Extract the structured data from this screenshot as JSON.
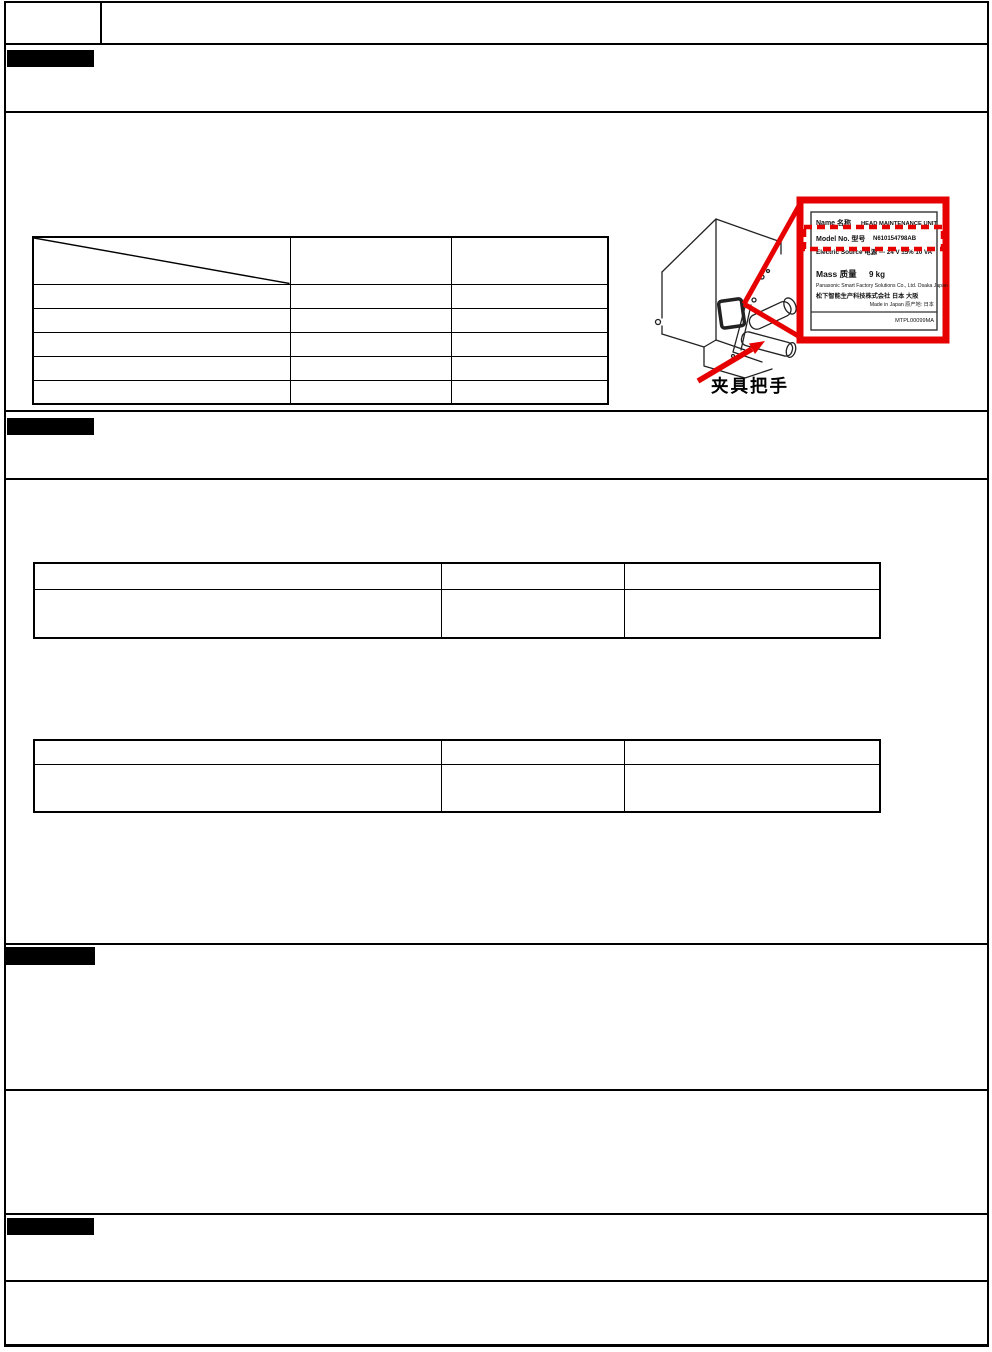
{
  "page": {
    "accent_color": "#e60000",
    "line_color": "#000000",
    "background": "#ffffff"
  },
  "header": {
    "left_cell": "",
    "title_cell": ""
  },
  "section_bars": {
    "bar1": "",
    "bar2": "",
    "bar3": "",
    "bar4": ""
  },
  "tables": {
    "overview": {
      "columns": [
        "",
        "",
        ""
      ],
      "rows": [
        [
          "",
          "",
          ""
        ],
        [
          "",
          "",
          ""
        ],
        [
          "",
          "",
          ""
        ],
        [
          "",
          "",
          ""
        ],
        [
          "",
          "",
          ""
        ]
      ]
    },
    "spec_a": {
      "columns": [
        "",
        "",
        ""
      ],
      "rows": [
        [
          "",
          "",
          ""
        ]
      ]
    },
    "spec_b": {
      "columns": [
        "",
        "",
        ""
      ],
      "rows": [
        [
          "",
          "",
          ""
        ]
      ]
    }
  },
  "figure": {
    "callout_label": "夹具把手",
    "nameplate": {
      "name_label": "Name 名称",
      "name_value": "HEAD MAINTENANCE UNIT",
      "model_label": "Model No. 型号",
      "model_value": "N610154798AB",
      "electric_label": "Electric Source 电源",
      "electric_value": "--- 24 V ±5% 10 VA",
      "mass_label": "Mass 质量",
      "mass_value": "9 kg",
      "maker_en": "Panasonic Smart Factory Solutions Co., Ltd. Osaka Japan",
      "maker_cn": "松下智能生产科技株式会社 日本 大阪",
      "origin": "Made in Japan 原产地: 日本",
      "plate_code": "MTPL00099MA"
    }
  }
}
